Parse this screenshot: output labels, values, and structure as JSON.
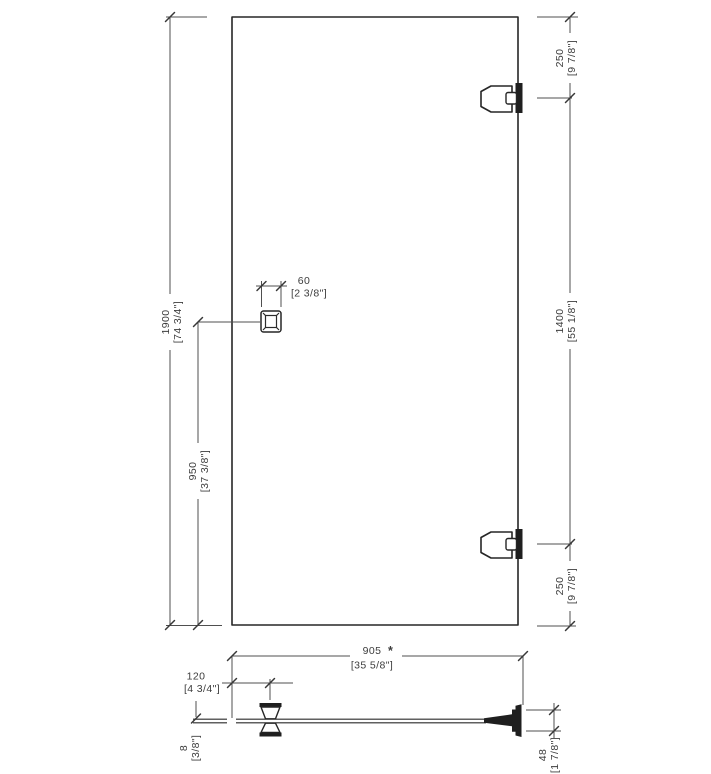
{
  "front_view": {
    "door_height": {
      "mm": "1900",
      "inches": "[74 3/4\"]"
    },
    "handle_height": {
      "mm": "950",
      "inches": "[37 3/8\"]"
    },
    "handle_width": {
      "mm": "60",
      "inches": "[2 3/8\"]"
    },
    "top_hinge_offset": {
      "mm": "250",
      "inches": "[9 7/8\"]"
    },
    "hinge_spacing": {
      "mm": "1400",
      "inches": "[55 1/8\"]"
    },
    "bottom_hinge_offset": {
      "mm": "250",
      "inches": "[9 7/8\"]"
    }
  },
  "section_view": {
    "door_width": {
      "mm": "905",
      "inches": "[35 5/8\"]",
      "note": "*"
    },
    "handle_offset": {
      "mm": "120",
      "inches": "[4 3/4\"]"
    },
    "glass_thickness": {
      "mm": "8",
      "inches": "[3/8\"]"
    },
    "hinge_depth": {
      "mm": "48",
      "inches": "[1 7/8\"]"
    }
  },
  "colors": {
    "asterisk": "#c22447",
    "object_line": "#262626",
    "dimension_line": "#4f4f4f",
    "text": "#3c3c3c",
    "background": "#ffffff"
  }
}
